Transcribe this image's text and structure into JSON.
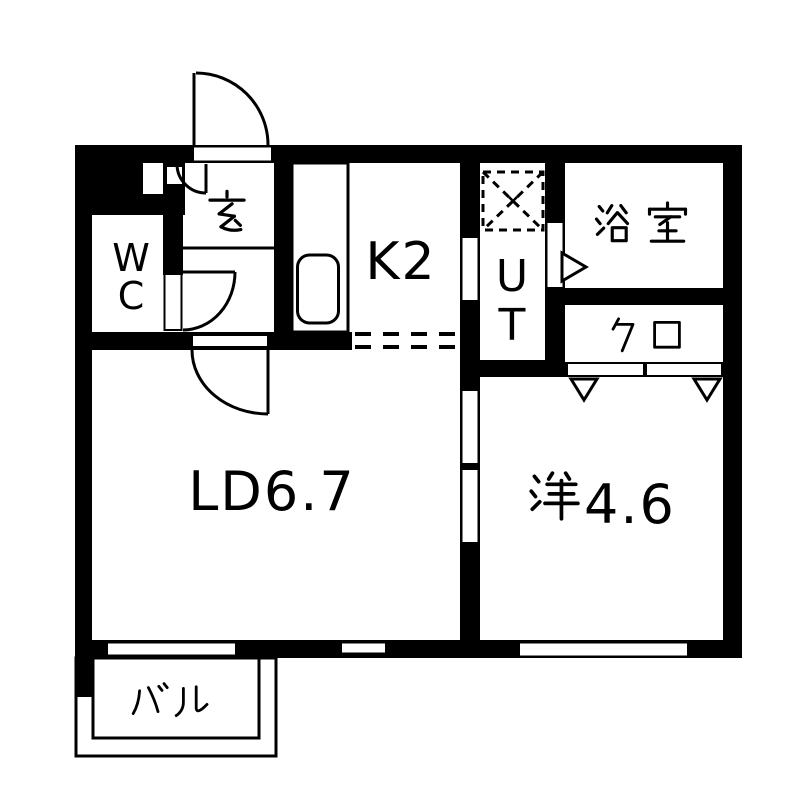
{
  "colors": {
    "wall": "#000000",
    "background": "#ffffff"
  },
  "rooms": {
    "genkan": {
      "label": "玄"
    },
    "wc": {
      "label": "WC",
      "letters": [
        "W",
        "C"
      ]
    },
    "kitchen": {
      "label": "K2"
    },
    "utility": {
      "label": "UT",
      "letters": [
        "U",
        "T"
      ]
    },
    "bathroom": {
      "label": "浴室"
    },
    "closet": {
      "label": "クロ"
    },
    "living_dining": {
      "label": "LD6.7"
    },
    "western": {
      "label": "洋4.6",
      "kanji": "洋",
      "number": "4.6"
    },
    "balcony": {
      "label": "バル"
    }
  },
  "symbols": {
    "washer_pan": "washing-machine-pan",
    "sink": "kitchen-sink",
    "counter": "kitchen-counter",
    "door_arcs": "hinged-door-swing",
    "triangles": "door-direction-marker",
    "sliding_rects": "closet-sliding-door",
    "dashed_line": "kitchen-ld-boundary",
    "white_wall_gaps": "windows-and-openings"
  }
}
